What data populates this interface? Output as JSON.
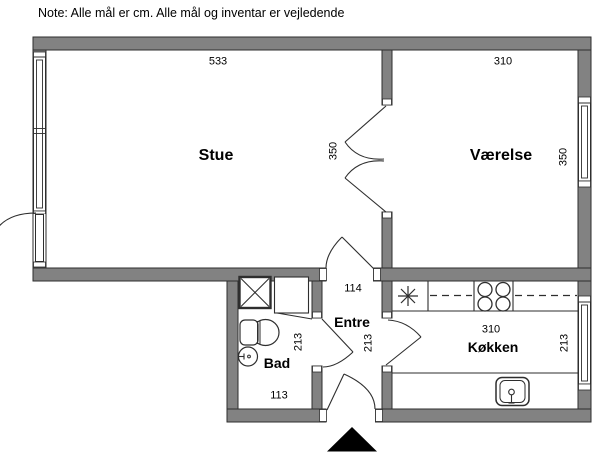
{
  "note": "Note: Alle mål er cm. Alle mål og inventar er vejledende",
  "rooms": {
    "stue": {
      "name": "Stue",
      "width": "533",
      "depth": "350"
    },
    "vaerelse": {
      "name": "Værelse",
      "width": "310",
      "depth": "350"
    },
    "entre": {
      "name": "Entre",
      "width": "114",
      "depth": "213"
    },
    "bad": {
      "name": "Bad",
      "width": "113",
      "depth": "213"
    },
    "koekken": {
      "name": "Køkken",
      "width": "310",
      "depth": "213"
    }
  },
  "fixtures": {
    "vent_shaft": "crossed-shaft",
    "toilet": "toilet",
    "washbasin": "round-basin",
    "stove": "four-burner-stove",
    "kitchen_sink": "sink-with-tap",
    "lamp_symbol": "asterisk",
    "entrance_marker": "black-triangle"
  },
  "colors": {
    "wall": "#828282",
    "outline": "#2e2e2e",
    "background": "#ffffff",
    "entrance_marker": "#000000"
  }
}
